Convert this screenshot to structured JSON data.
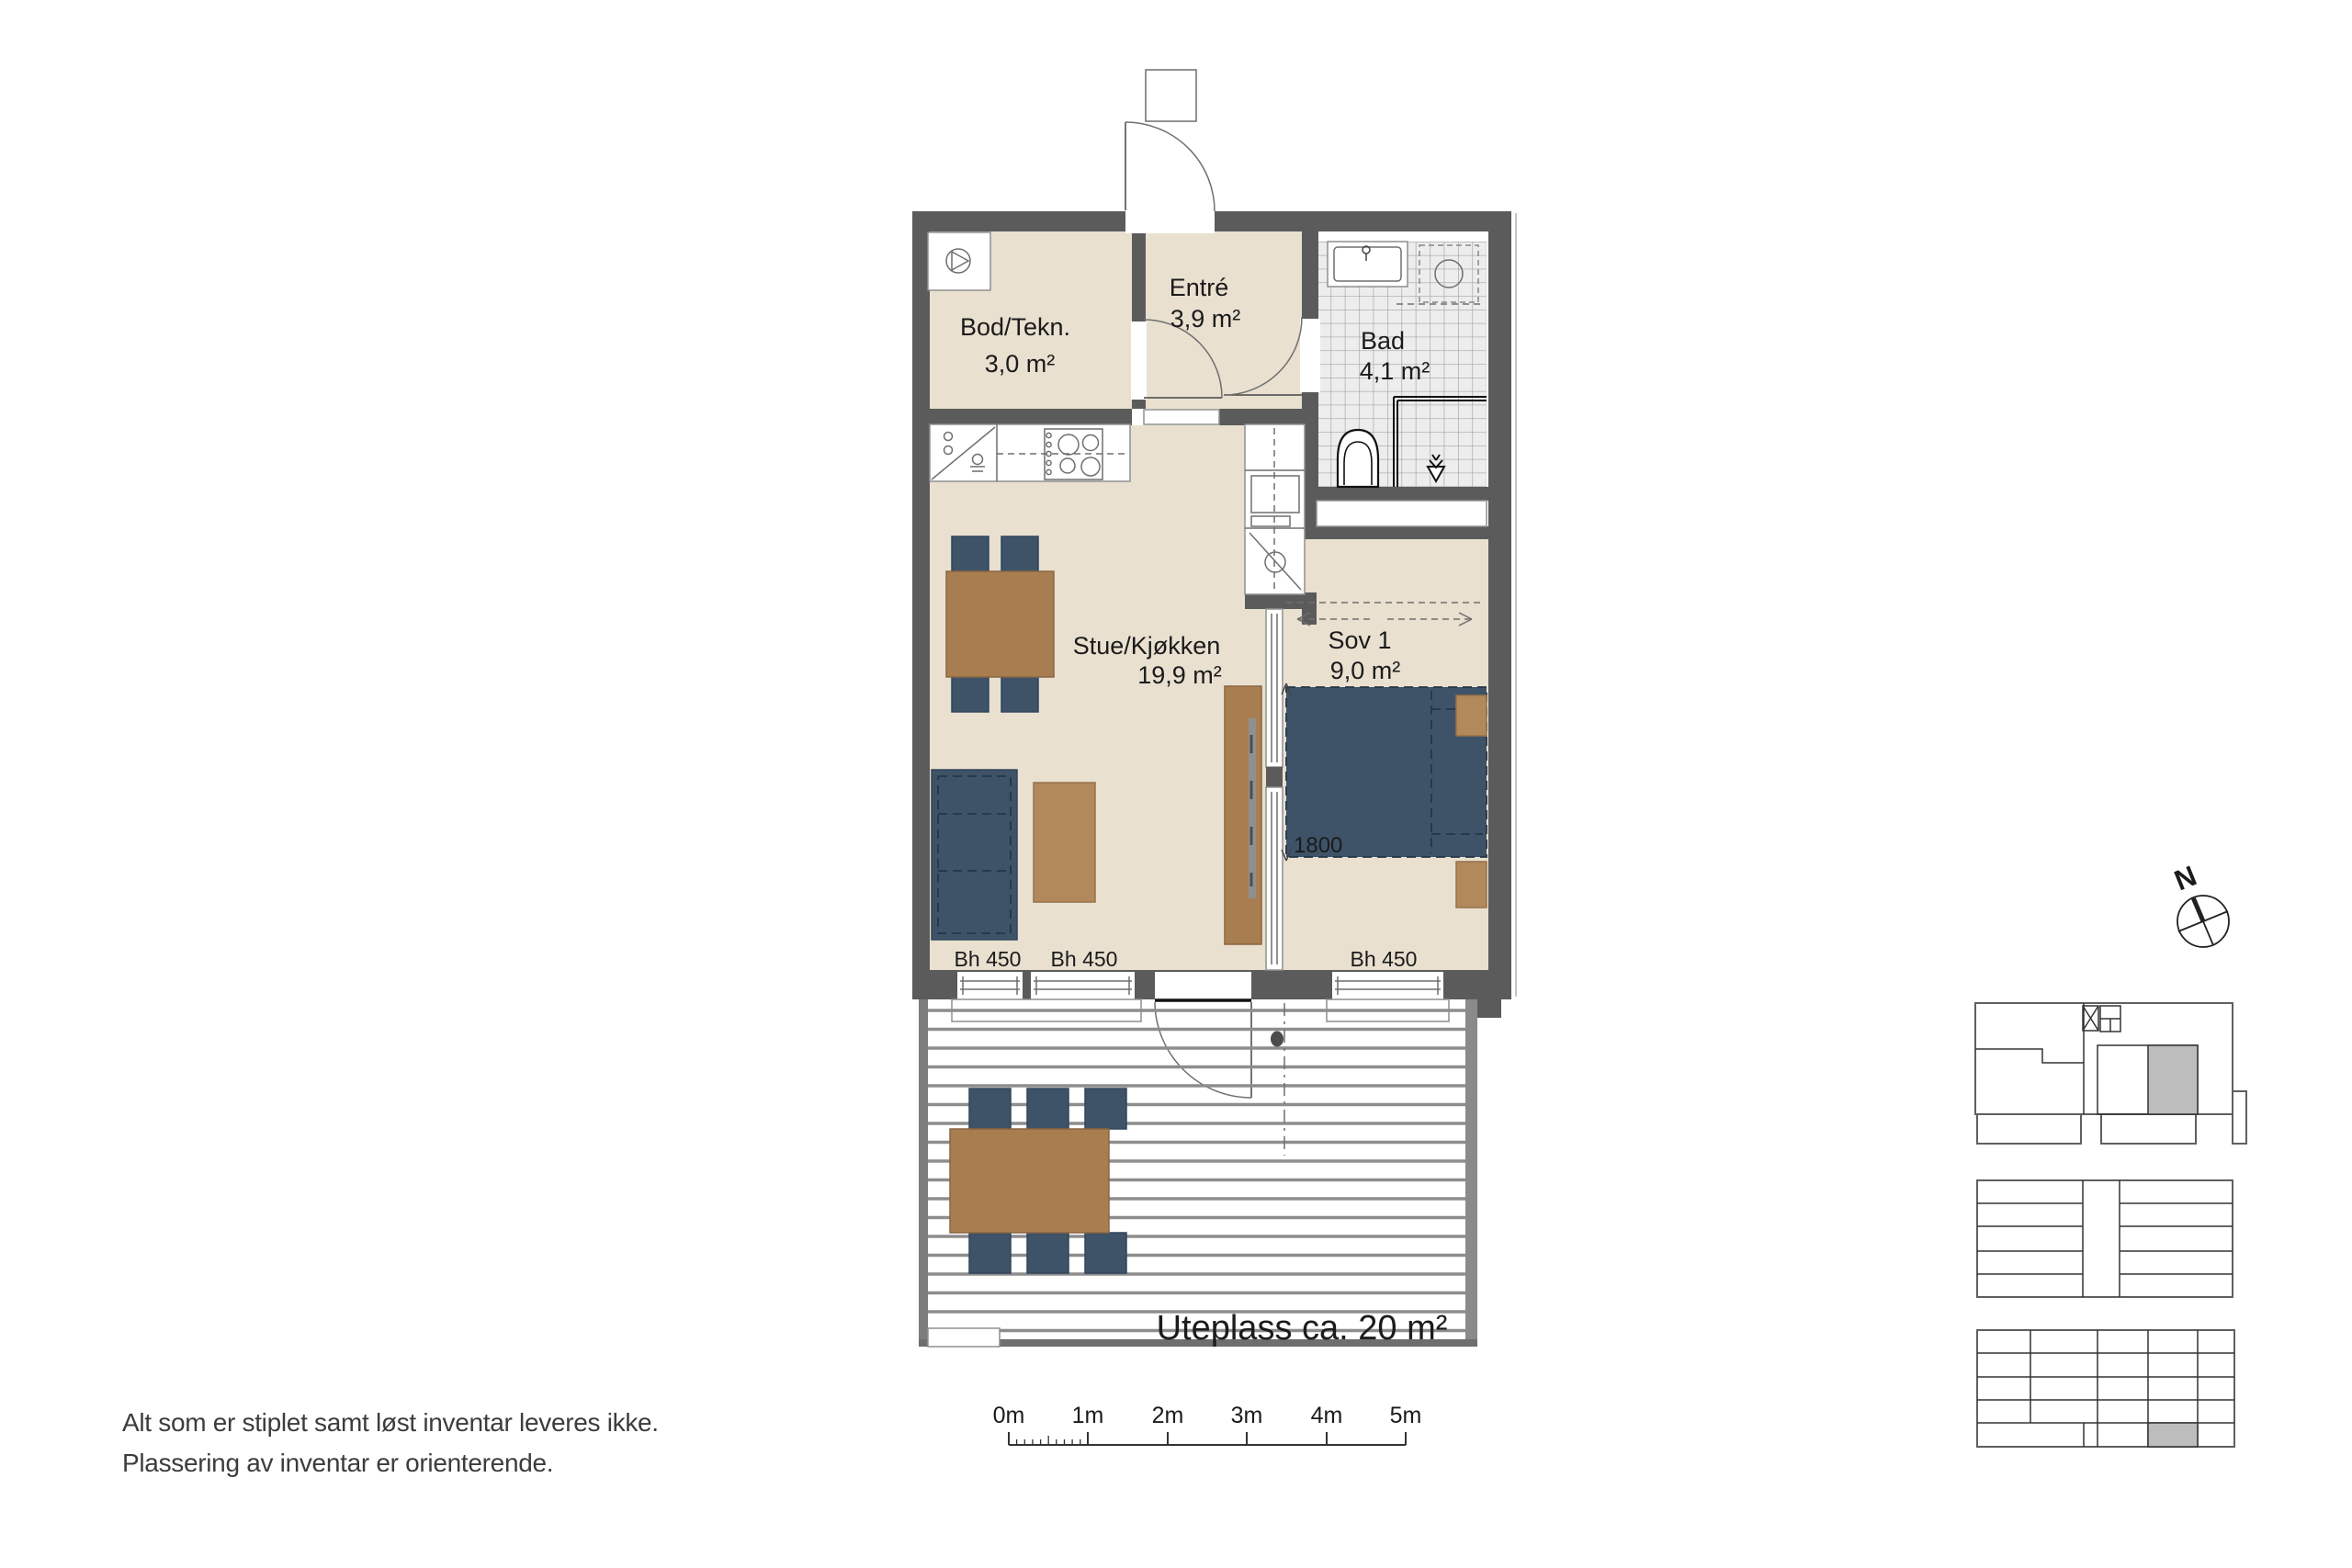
{
  "rooms": {
    "bod": {
      "name": "Bod/Tekn.",
      "area": "3,0 m²"
    },
    "entre": {
      "name": "Entré",
      "area": "3,9 m²"
    },
    "bad": {
      "name": "Bad",
      "area": "4,1 m²"
    },
    "stue": {
      "name": "Stue/Kjøkken",
      "area": "19,9 m²"
    },
    "sov": {
      "name": "Sov 1",
      "area": "9,0 m²"
    },
    "uteplass": {
      "label": "Uteplass ca. 20 m²"
    }
  },
  "annotations": {
    "bh_labels": [
      "Bh 450",
      "Bh 450",
      "Bh 450"
    ],
    "bed_width": "1800"
  },
  "scale_bar": {
    "labels": [
      "0m",
      "1m",
      "2m",
      "3m",
      "4m",
      "5m"
    ]
  },
  "compass": {
    "label": "N"
  },
  "disclaimer": {
    "line1": "Alt som er stiplet samt løst inventar leveres ikke.",
    "line2": "Plassering av inventar er orienterende."
  },
  "colors": {
    "floor": "#e9e0d0",
    "wall": "#5b5b5b",
    "furniture_blue": "#3e5368",
    "wood": "#a87e51",
    "wood_light": "#b1895b",
    "tile_floor": "#ededed",
    "unit_highlight": "#bdbdbd"
  }
}
